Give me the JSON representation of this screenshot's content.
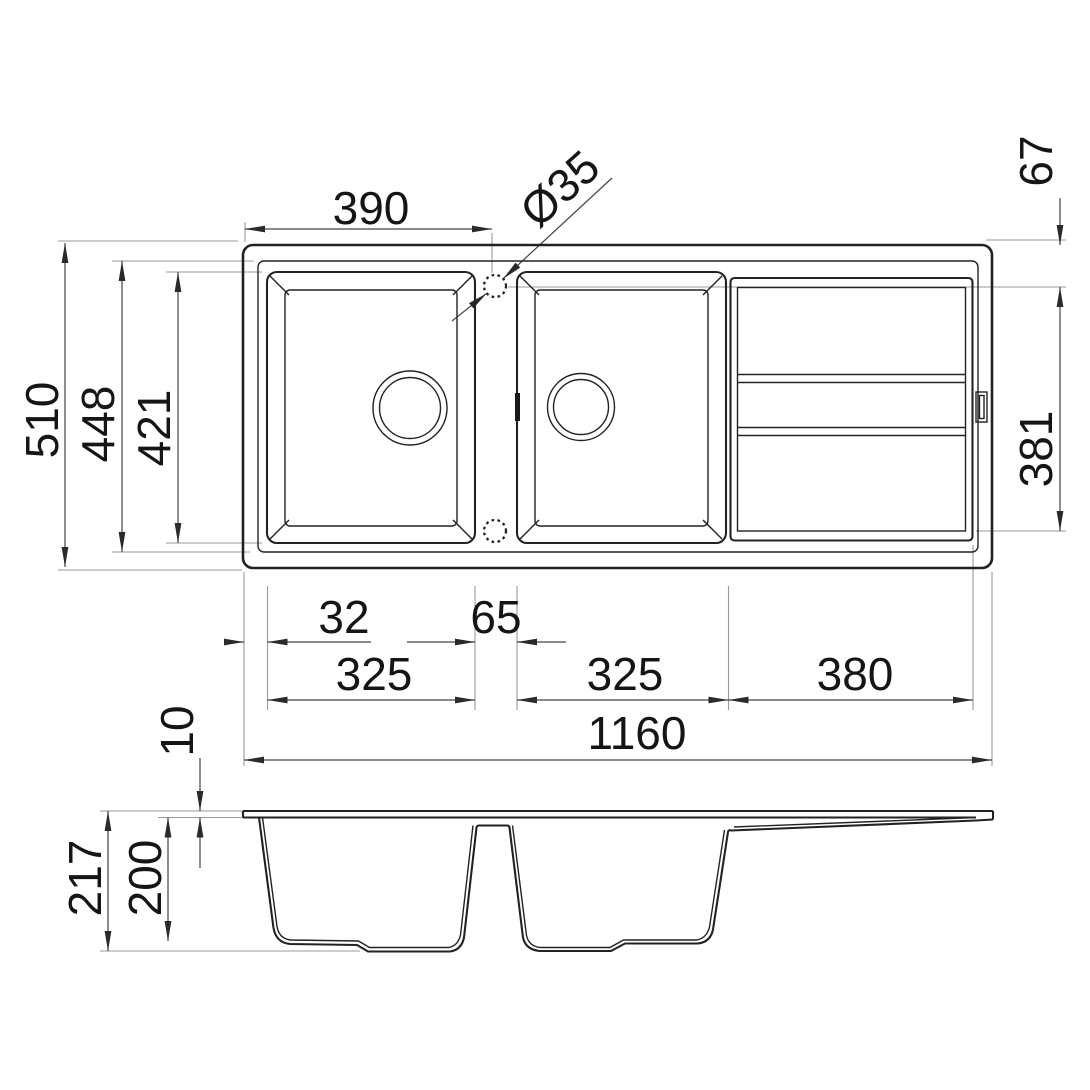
{
  "drawing": {
    "kind": "kitchen-sink-dimension-drawing",
    "colors": {
      "line": "#222222",
      "dimension_line": "#444444",
      "extension_line": "#9a9a9a",
      "text": "#151515",
      "background": "#ffffff"
    },
    "dims": {
      "width_to_tap_center": "390",
      "tap_hole_diameter": "Ø35",
      "tap_center_from_edge": "67",
      "overall_depth": "510",
      "inner_rim_depth": "448",
      "bowl_front_to_back": "421",
      "drainer_depth": "381",
      "edge_to_bowl": "32",
      "between_bowls": "65",
      "bowl1_width": "325",
      "bowl2_width": "325",
      "drainer_width": "380",
      "overall_length": "1160",
      "rim_thickness": "10",
      "overall_height": "217",
      "bowl_depth": "200"
    }
  }
}
